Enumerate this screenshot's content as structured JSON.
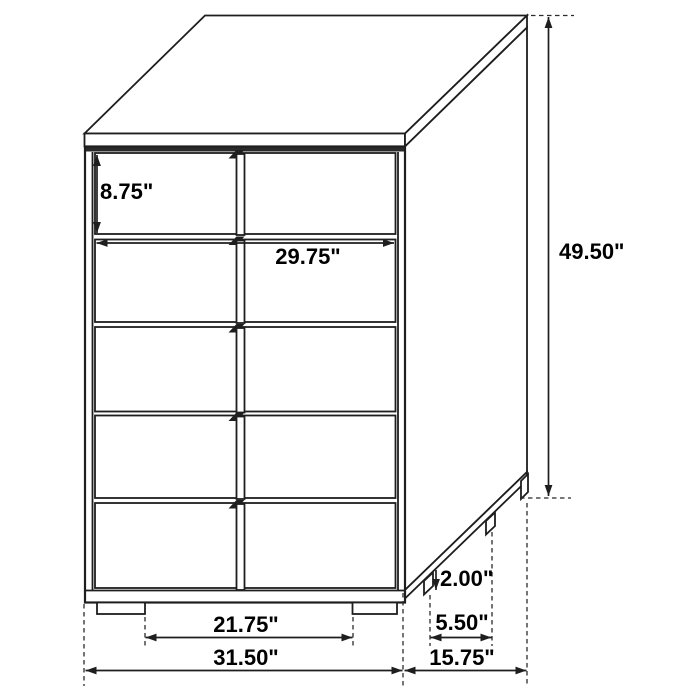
{
  "diagram": {
    "subject": "5-drawer chest",
    "view": "three-quarter perspective line drawing with dimension callouts",
    "drawer_count": 5,
    "unit": "inches",
    "colors": {
      "line": "#1e1e1e",
      "background": "#ffffff",
      "label": "#000000"
    },
    "dimensions": {
      "drawer_height": "8.75\"",
      "drawer_width": "29.75\"",
      "overall_height": "49.50\"",
      "foot_height": "2.00\"",
      "side_foot_spacing": "5.50\"",
      "front_foot_spacing": "21.75\"",
      "overall_width": "31.50\"",
      "overall_depth": "15.75\""
    }
  }
}
